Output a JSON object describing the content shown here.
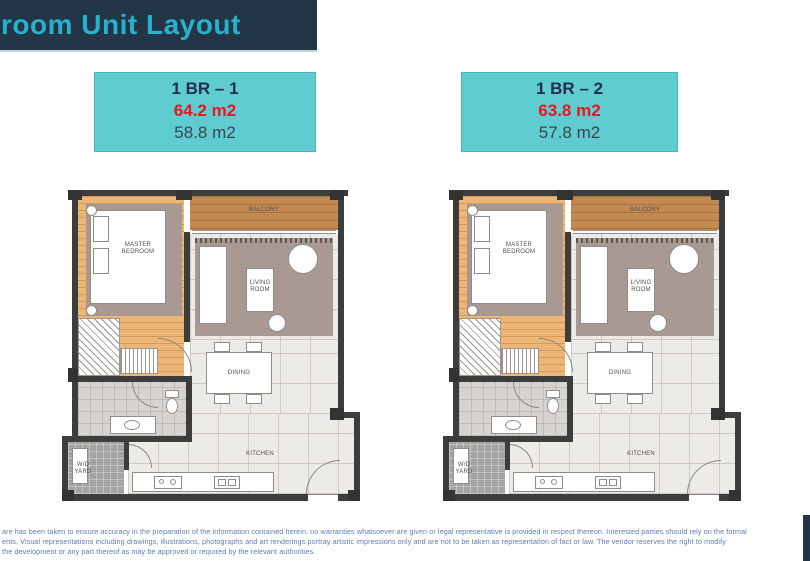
{
  "page": {
    "title": "room Unit Layout"
  },
  "colors": {
    "banner_bg": "#223648",
    "banner_title": "#29b0cc",
    "header_bg": "#5fccd2",
    "header_border": "#49b5bf",
    "header_navy": "#20304a",
    "header_red": "#e8161d",
    "header_gray": "#3c4450",
    "disclaimer_text": "#5b7db8",
    "wall": "#3e3d3d",
    "wood": "#ecb677",
    "balcony_wood": "#c28a50",
    "rug": "#a89a93",
    "tile": "#edebe8",
    "bath": "#d6d3d0",
    "yard": "#a3a3a1",
    "accent_bar": "#223648"
  },
  "units": [
    {
      "name": "1 BR – 1",
      "area_gross": "64.2 m2",
      "area_net": "58.8 m2"
    },
    {
      "name": "1 BR – 2",
      "area_gross": "63.8 m2",
      "area_net": "57.8 m2"
    }
  ],
  "plans": [
    {
      "rooms": {
        "master_bedroom": "MASTER BEDROOM",
        "balcony": "BALCONY",
        "living_room": "LIVING ROOM",
        "dining": "DINING",
        "kitchen": "KITCHEN",
        "wd_yard": "W/D YARD"
      }
    },
    {
      "rooms": {
        "master_bedroom": "MASTER BEDROOM",
        "balcony": "BALCONY",
        "living_room": "LIVING ROOM",
        "dining": "DINING",
        "kitchen": "KITCHEN",
        "wd_yard": "W/D YARD"
      }
    }
  ],
  "disclaimer": {
    "line1": "are has been taken to ensure accuracy in the preparation of the information contained herein, no warranties whatsoever are given or legal representative is provided in respect thereon. Interested parties should rely on the formal",
    "line2": "ents. Visual representations including drawings, illustrations, photographs and art renderings portray artistic impressions only and are not to be taken as representation of fact or law. The vendor reserves the right to modify",
    "line3": "the development or any part thereof as may be approved or required by the relevant authorities."
  }
}
